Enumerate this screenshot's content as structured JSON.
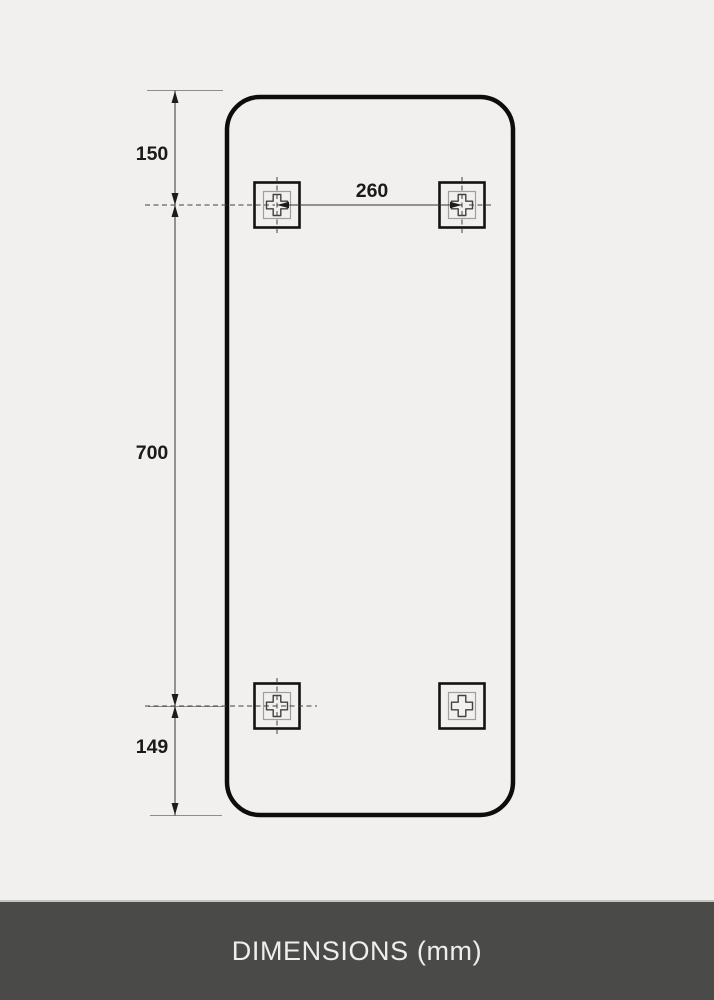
{
  "footer": {
    "label": "DIMENSIONS (mm)"
  },
  "drawing": {
    "type": "mounting-dimension-diagram",
    "unit": "mm",
    "dimensions": {
      "top_edge_to_holes": "150",
      "holes_vertical_spacing": "700",
      "holes_to_bottom_edge": "149",
      "holes_horizontal_spacing": "260"
    },
    "colors": {
      "background": "#f1f0ee",
      "panel_outline": "#0d0d0b",
      "dimension_line": "#55534f",
      "label_text": "#1b1a18",
      "footer_background": "#4a4a48",
      "footer_text": "#efeeeb"
    }
  }
}
